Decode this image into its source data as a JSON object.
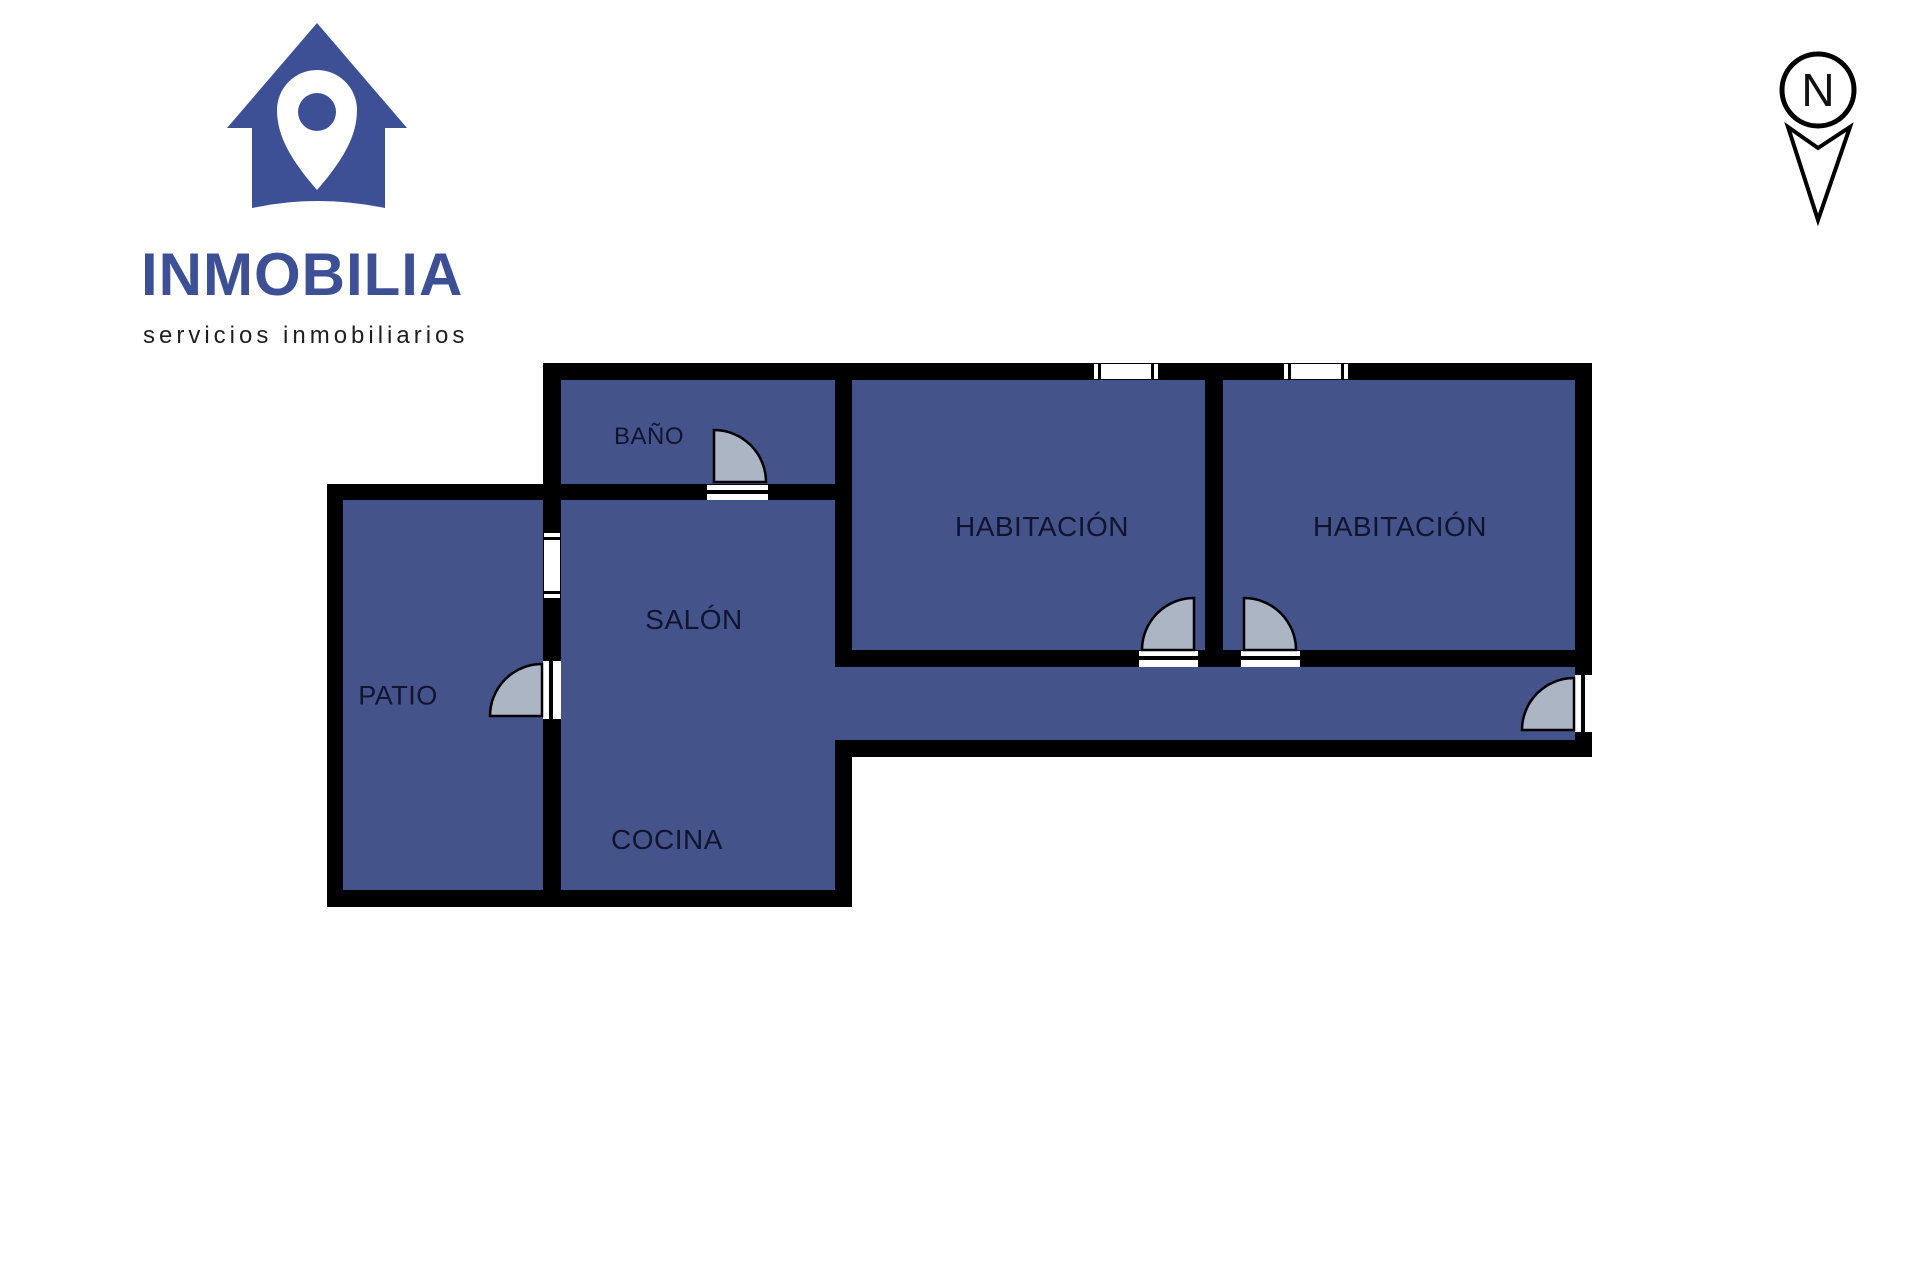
{
  "brand": {
    "name": "INMOBILIA",
    "tagline": "servicios inmobiliarios"
  },
  "compass": {
    "north_label": "N"
  },
  "floorplan": {
    "rooms": [
      {
        "id": "bano",
        "label": "BAÑO"
      },
      {
        "id": "salon",
        "label": "SALÓN"
      },
      {
        "id": "cocina",
        "label": "COCINA"
      },
      {
        "id": "patio",
        "label": "PATIO"
      },
      {
        "id": "habitacion-1",
        "label": "HABITACIÓN"
      },
      {
        "id": "habitacion-2",
        "label": "HABITACIÓN"
      }
    ],
    "doors": [
      {
        "room": "bano",
        "type": "swing"
      },
      {
        "room": "patio",
        "type": "swing"
      },
      {
        "room": "habitacion-1",
        "type": "swing"
      },
      {
        "room": "habitacion-2",
        "type": "swing"
      },
      {
        "room": "entrance",
        "type": "swing"
      }
    ],
    "windows": [
      {
        "wall": "top",
        "room": "habitacion-1"
      },
      {
        "wall": "top",
        "room": "habitacion-2"
      },
      {
        "wall": "patio-salon",
        "room": "salon"
      }
    ]
  },
  "icons": {
    "logo": "house-with-location-pin-icon",
    "compass": "north-arrow-icon"
  },
  "colors": {
    "brand_blue": "#3e5095",
    "room_fill": "#45538b",
    "door_fill": "#abb5c3",
    "wall_color": "#000000",
    "label_color": "#10142f",
    "tagline_color": "#1f1f1f"
  }
}
